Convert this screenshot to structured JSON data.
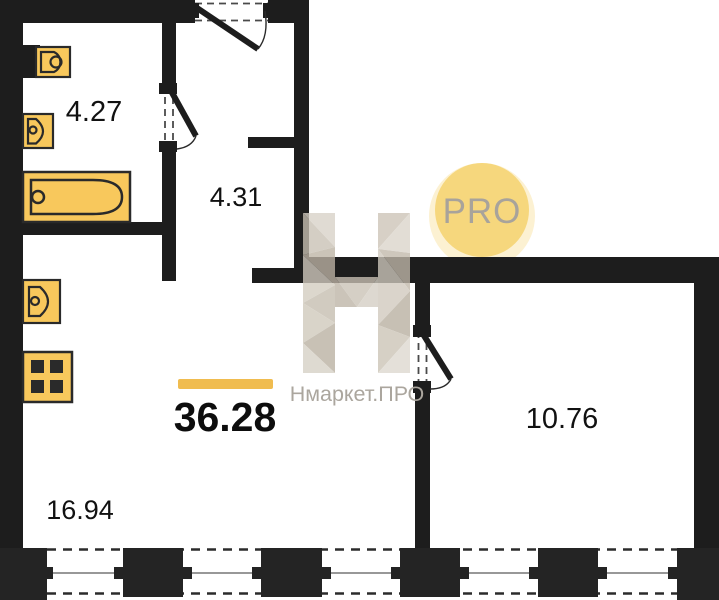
{
  "watermark": {
    "badge_label": "PRO",
    "brand_name": "Нмаркет.ПРО",
    "logo_letter": "Н"
  },
  "plan": {
    "total_area_label": "36.28",
    "rooms": {
      "bathroom": {
        "area": "4.27"
      },
      "hallway": {
        "area": "4.31"
      },
      "bedroom": {
        "area": "10.76"
      },
      "living_kitchen": {
        "area": "16.94"
      }
    },
    "fixtures": [
      "toilet-icon",
      "bathroom-sink-icon",
      "bathtub-icon",
      "kitchen-sink-icon",
      "stove-icon",
      "duct-icon"
    ],
    "doors": [
      "entrance-door",
      "bathroom-door",
      "bedroom-door"
    ],
    "windows_count": 4
  },
  "colors": {
    "wall": "#1d1d1d",
    "accent_bar": "#F0BC4F",
    "fixture_fill": "#F8C85C",
    "badge_fill": "#F6D77D",
    "badge_text": "#A8A39B",
    "watermark_text": "#ABA69E"
  }
}
